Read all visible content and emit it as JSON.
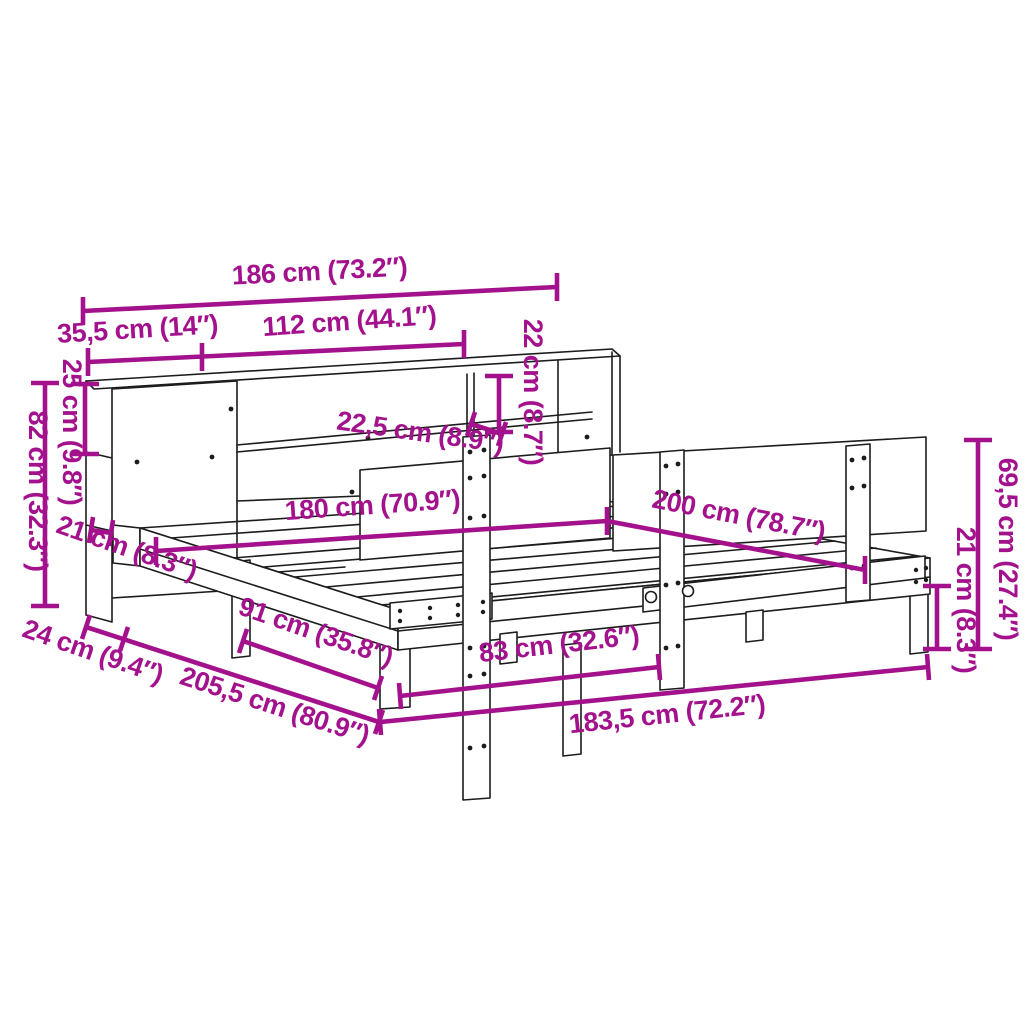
{
  "diagram": {
    "background_color": "#FFFFFF",
    "dimension_color": "#A3128C",
    "drawing_line_color": "#1C1C1C",
    "dimensions": {
      "headboard_width_total": "186 cm (73.2″)",
      "headboard_left_section_width": "35,5 cm (14″)",
      "headboard_middle_section_width": "112 cm (44.1″)",
      "top_compartment_height_right": "22 cm (8.7″)",
      "top_compartment_height_left": "25 cm (9.8″)",
      "headboard_height": "82 cm (32.3″)",
      "frame_rail_height": "21 cm (8.3″)",
      "shelf_depth": "22,5 cm (8.9″)",
      "mattress_width": "180 cm (70.9″)",
      "mattress_length": "200 cm (78.7″)",
      "backrest_total_height": "69,5 cm (27.4″)",
      "leg_height": "21 cm (8.3″)",
      "headboard_depth": "24 cm (9.4″)",
      "frame_total_length": "205,5 cm (80.9″)",
      "half_frame_width": "91 cm (35.8″)",
      "foot_rail_section_width": "83 cm (32.6″)",
      "frame_side_length": "183,5 cm (72.2″)"
    }
  }
}
